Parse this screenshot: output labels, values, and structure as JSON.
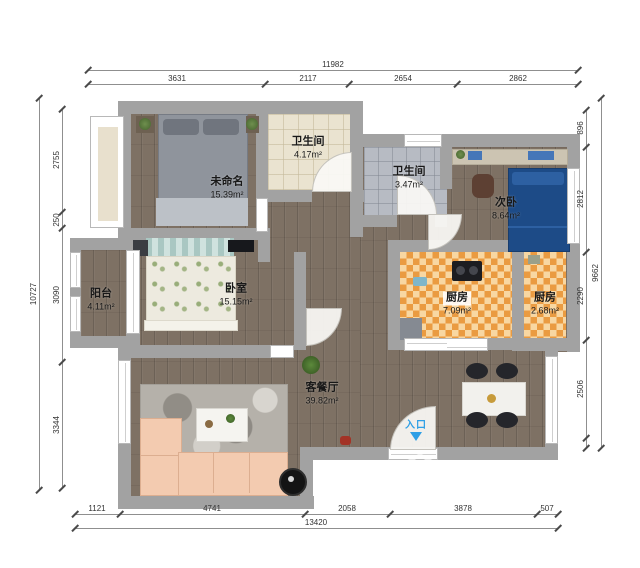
{
  "dims": {
    "top": {
      "total": "11982",
      "segs": [
        "3631",
        "2117",
        "2654",
        "2862"
      ]
    },
    "bottom": {
      "total": "13420",
      "segs": [
        "1121",
        "4741",
        "2058",
        "3878",
        "507"
      ]
    },
    "left": {
      "total": "10727",
      "segs": [
        "2755",
        "250",
        "3090",
        "3344"
      ]
    },
    "right": {
      "total": "9662",
      "segs": [
        "896",
        "2812",
        "2290",
        "2506"
      ]
    }
  },
  "rooms": {
    "unnamed": {
      "name": "未命名",
      "area": "15.39m²"
    },
    "bath1": {
      "name": "卫生间",
      "area": "4.17m²"
    },
    "bath2": {
      "name": "卫生间",
      "area": "3.47m²"
    },
    "bedroom2": {
      "name": "次卧",
      "area": "8.64m²"
    },
    "kitchen1": {
      "name": "厨房",
      "area": "7.09m²"
    },
    "kitchen2": {
      "name": "厨房",
      "area": "2.68m²"
    },
    "balcony": {
      "name": "阳台",
      "area": "4.11m²"
    },
    "bedroom1": {
      "name": "卧室",
      "area": "15.15m²"
    },
    "living": {
      "name": "客餐厅",
      "area": "39.82m²"
    }
  },
  "entrance": {
    "label": "入口"
  },
  "watermark": {
    "brand": "小尼宅配"
  },
  "colors": {
    "wall": "#a2a2a2",
    "wood_floor": "#7e7164",
    "kitchen_tile": "#f0a850",
    "bath1_tile": "#eae3d0",
    "bath2_tile": "#b7bbc3",
    "bed_blue": "#1d4b87",
    "sofa_peach": "#f3cbb0",
    "entrance_blue": "#2e9fe6"
  }
}
